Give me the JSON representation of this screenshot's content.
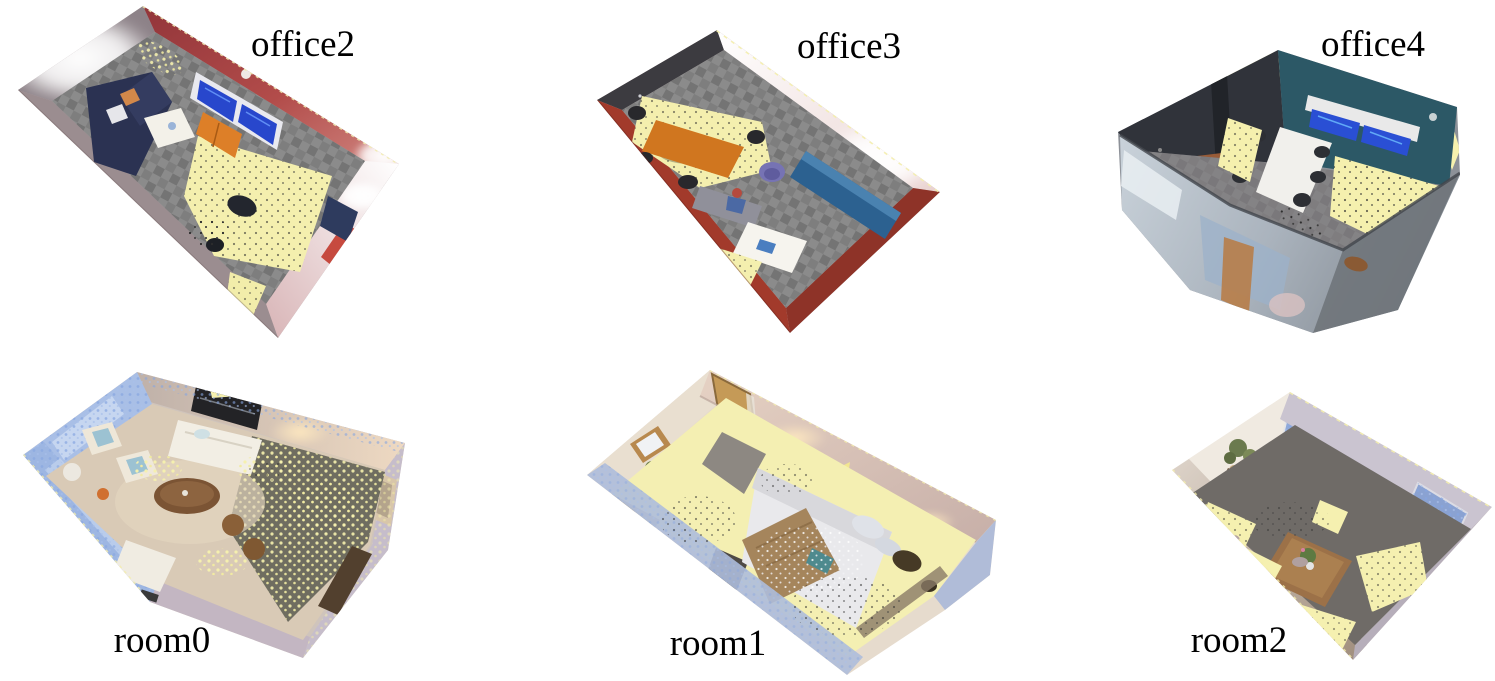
{
  "figure": {
    "type": "point-cloud-room-renders-grid",
    "background": "#ffffff",
    "rows": 2,
    "cols": 3,
    "label_color": "#000000",
    "missing_region_yellow": "#f5f0ae",
    "scenes": [
      {
        "id": "office2",
        "label": "office2",
        "position": "top-left",
        "content": "top-down point cloud of an office lounge",
        "colors": {
          "wall_red": "#a84341",
          "wall_glow": "#ffffff",
          "carpet_gray": "#858585",
          "sofa_navy": "#2b3252",
          "coffee_table_white": "#f3f1e9",
          "tv_screen_blue": "#2847cc",
          "cabinet_orange": "#dd7f28",
          "gap_yellow": "#f5f0ae"
        }
      },
      {
        "id": "office3",
        "label": "office3",
        "position": "top-center",
        "content": "top-down point cloud of an office with meeting table",
        "colors": {
          "wall_dark": "#3c3b40",
          "wall_glow_pink": "#f3e4e2",
          "rim_red": "#a23a2b",
          "carpet_gray": "#858585",
          "table_orange": "#d0761f",
          "bench_blue": "#2c6190",
          "chair_purple": "#7673b4",
          "table_white": "#f6f4ee",
          "gap_yellow": "#f5f0ae"
        }
      },
      {
        "id": "office4",
        "label": "office4",
        "position": "top-right",
        "content": "point cloud of a conference room with monitors",
        "colors": {
          "wall_teal": "#2c5866",
          "wall_dark": "#31343a",
          "monitor_blue": "#2a4fd4",
          "bench_brown": "#975a36",
          "table_white": "#f1f0ec",
          "front_blur_gray": "#a9b2bc",
          "gap_yellow": "#f5f0ae"
        }
      },
      {
        "id": "room0",
        "label": "room0",
        "position": "bottom-left",
        "content": "point cloud of a living room with sofa and armchairs",
        "colors": {
          "wall_blue": "#a9c0e8",
          "wall_tan": "#d2c2b2",
          "floor_tan": "#d9cab6",
          "floor_olive": "#6f6d60",
          "sofa_white": "#f2eee4",
          "cushion_blue": "#9cc2d2",
          "table_brown": "#7b5434",
          "gap_yellow": "#f5f0ae"
        }
      },
      {
        "id": "room1",
        "label": "room1",
        "position": "bottom-center",
        "content": "point cloud of a bedroom with bed, dresser and mirror",
        "colors": {
          "wall_cream": "#e9dfd0",
          "door_wood": "#c59a57",
          "bed_white": "#e9e9ec",
          "blanket_brown": "#a5855c",
          "floor_yellow": "#f4efb2",
          "trim_blue": "#aebcda",
          "gap_yellow": "#f5f0ae"
        }
      },
      {
        "id": "room2",
        "label": "room2",
        "position": "bottom-right",
        "content": "point cloud of a room with center table, plants and windows",
        "colors": {
          "wall_cream": "#f0eae1",
          "window_blue": "#8fa9da",
          "floor_gray": "#6f6b67",
          "table_wood": "#9c7148",
          "wall_lavender": "#cac4d0",
          "gap_yellow": "#f5f0ae"
        }
      }
    ]
  }
}
